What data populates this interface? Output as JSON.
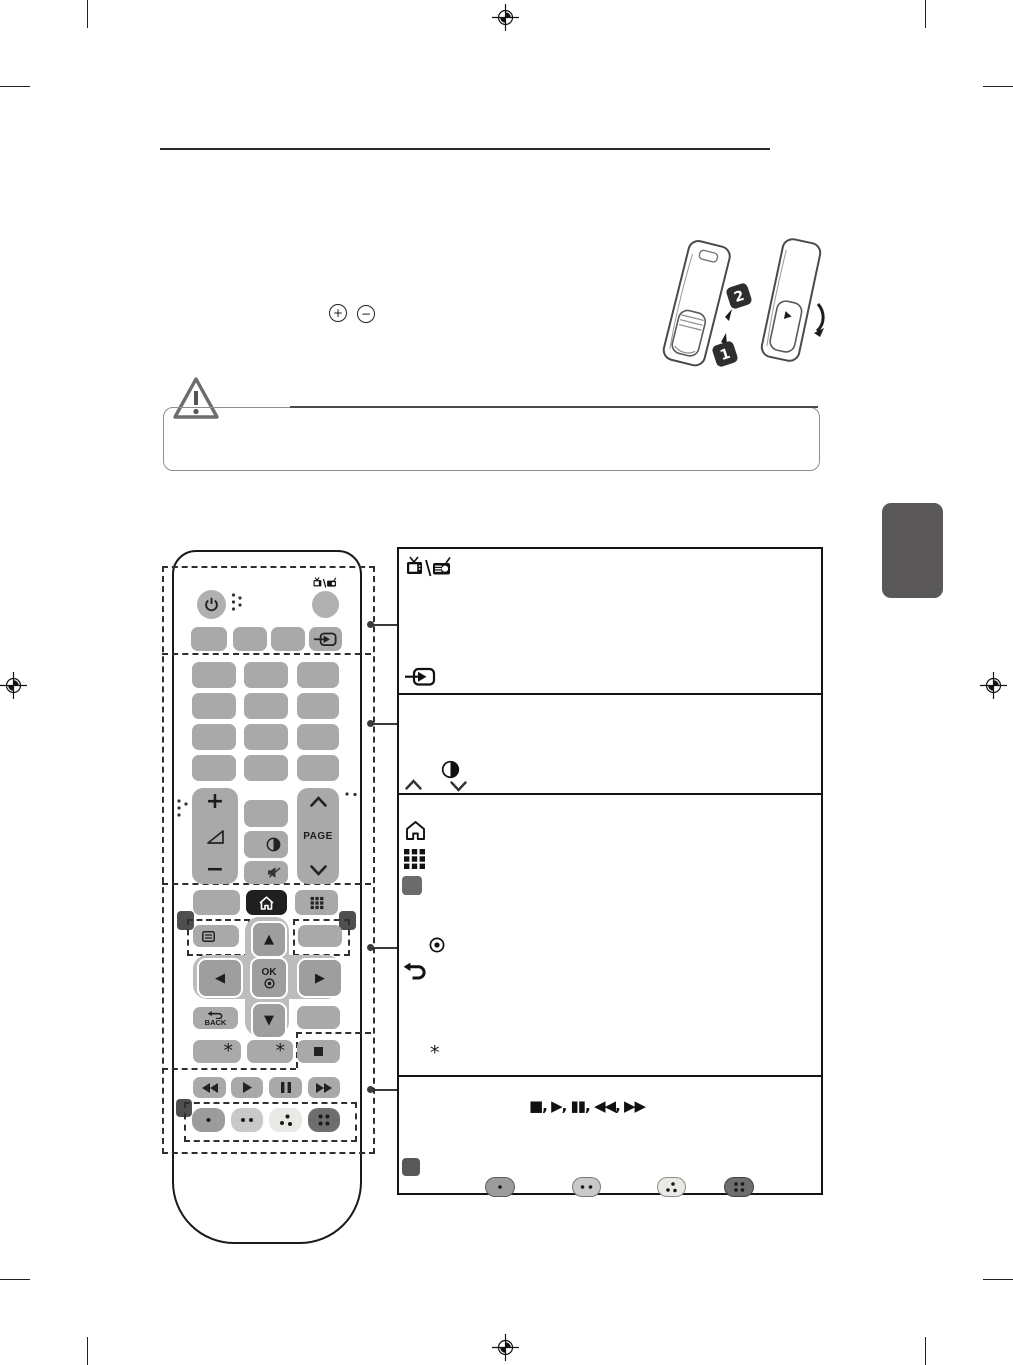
{
  "page": {
    "background": "#ffffff",
    "side_tab_color": "#595757"
  },
  "top_section": {
    "battery_plus_symbol": "+",
    "battery_minus_symbol": "−",
    "callout_1": "1",
    "callout_2": "2"
  },
  "caution": {
    "icon": "warning-triangle"
  },
  "remote": {
    "labels": {
      "volume_plus": "+",
      "volume_minus": "−",
      "page": "PAGE",
      "ok": "OK",
      "back": "BACK",
      "asterisk_left": "*",
      "asterisk_right": "*"
    },
    "icons": [
      "power-icon",
      "tv-rad-icon",
      "input-icon",
      "volume-icon",
      "contrast-icon",
      "mute-icon",
      "page-up-icon",
      "page-down-icon",
      "home-icon",
      "apps-icon",
      "list-icon",
      "up-icon",
      "down-icon",
      "left-icon",
      "right-icon",
      "record-icon",
      "back-icon",
      "stop-icon",
      "rewind-icon",
      "play-icon",
      "pause-icon",
      "fast-forward-icon",
      "color-dot-1",
      "color-dot-2",
      "color-dot-3",
      "color-dot-4"
    ]
  },
  "table": {
    "rows": [
      {
        "icons": [
          "tv-radio-icon",
          "input-icon"
        ]
      },
      {
        "icons": [
          "contrast-icon",
          "chevron-up-icon",
          "chevron-down-icon"
        ]
      },
      {
        "icons": [
          "home-icon",
          "apps-grid-icon",
          "gray-button-swatch",
          "record-icon",
          "back-arrow-icon"
        ],
        "footnote_symbol": "*"
      },
      {
        "media_symbols": "■, ▶, ▮▮, ◀◀, ▶▶",
        "icons": [
          "dark-button-swatch",
          "dot-button-1",
          "dot-button-2",
          "dot-button-3",
          "dot-button-4"
        ]
      }
    ]
  },
  "colors": {
    "button_gray": "#a9a9a9",
    "nav_gray": "#9e9e9e",
    "cluster_gray": "#bcbcbc",
    "home_button": "#1f1f1f",
    "marker": "#4f4f4f",
    "pill_1": "#9c9c9c",
    "pill_2": "#c9c9c9",
    "pill_3": "#e9e9e6",
    "pill_4": "#6e6e6e"
  }
}
